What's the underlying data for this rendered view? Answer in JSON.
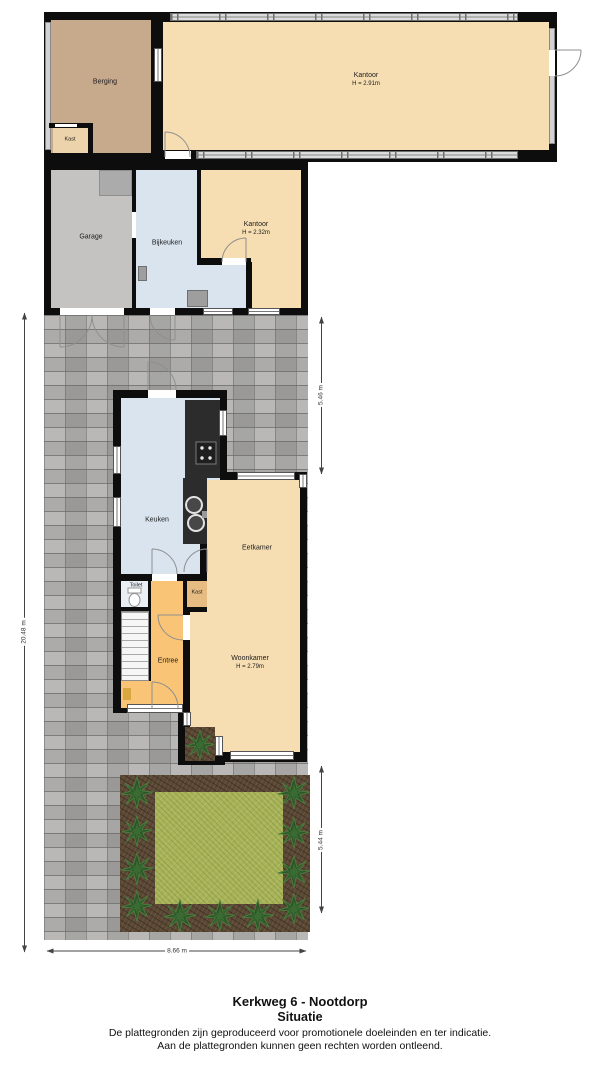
{
  "title": {
    "address": "Kerkweg 6 - Nootdorp",
    "view": "Situatie"
  },
  "disclaimer": {
    "line1": "De plattegronden zijn geproduceerd voor promotionele doeleinden en ter indicatie.",
    "line2": "Aan de plattegronden kunnen geen rechten worden ontleend."
  },
  "rooms": {
    "berging": {
      "label": "Berging"
    },
    "kast_berging": {
      "label": "Kast"
    },
    "kantoor_groot": {
      "label": "Kantoor",
      "height": "H = 2.91m"
    },
    "garage": {
      "label": "Garage"
    },
    "bijkeuken": {
      "label": "Bijkeuken"
    },
    "kantoor_klein": {
      "label": "Kantoor",
      "height": "H = 2.32m"
    },
    "keuken": {
      "label": "Keuken"
    },
    "eetkamer": {
      "label": "Eetkamer"
    },
    "toilet": {
      "label": "Toilet"
    },
    "kast_hal": {
      "label": "Kast"
    },
    "entree": {
      "label": "Entree"
    },
    "woonkamer": {
      "label": "Woonkamer",
      "height": "H = 2.79m"
    }
  },
  "dimensions": {
    "left": "20.48 m",
    "right_top": "5.46 m",
    "right_bottom": "5.44 m",
    "bottom": "8.66 m"
  },
  "colors": {
    "wall": "#0d0d0d",
    "office": "#f6deb2",
    "storage": "#c7a98c",
    "closet": "#edd3ab",
    "garagefloor": "#c4c3c2",
    "kitchen": "#d9e4ef",
    "hall": "#f9c475",
    "hallcloset": "#e7bc82",
    "paving": "#aeadab",
    "grass": "#a8b457",
    "soil": "#5a4733",
    "bush": "#2d5429",
    "toiletfloor": "#e9eff5"
  }
}
